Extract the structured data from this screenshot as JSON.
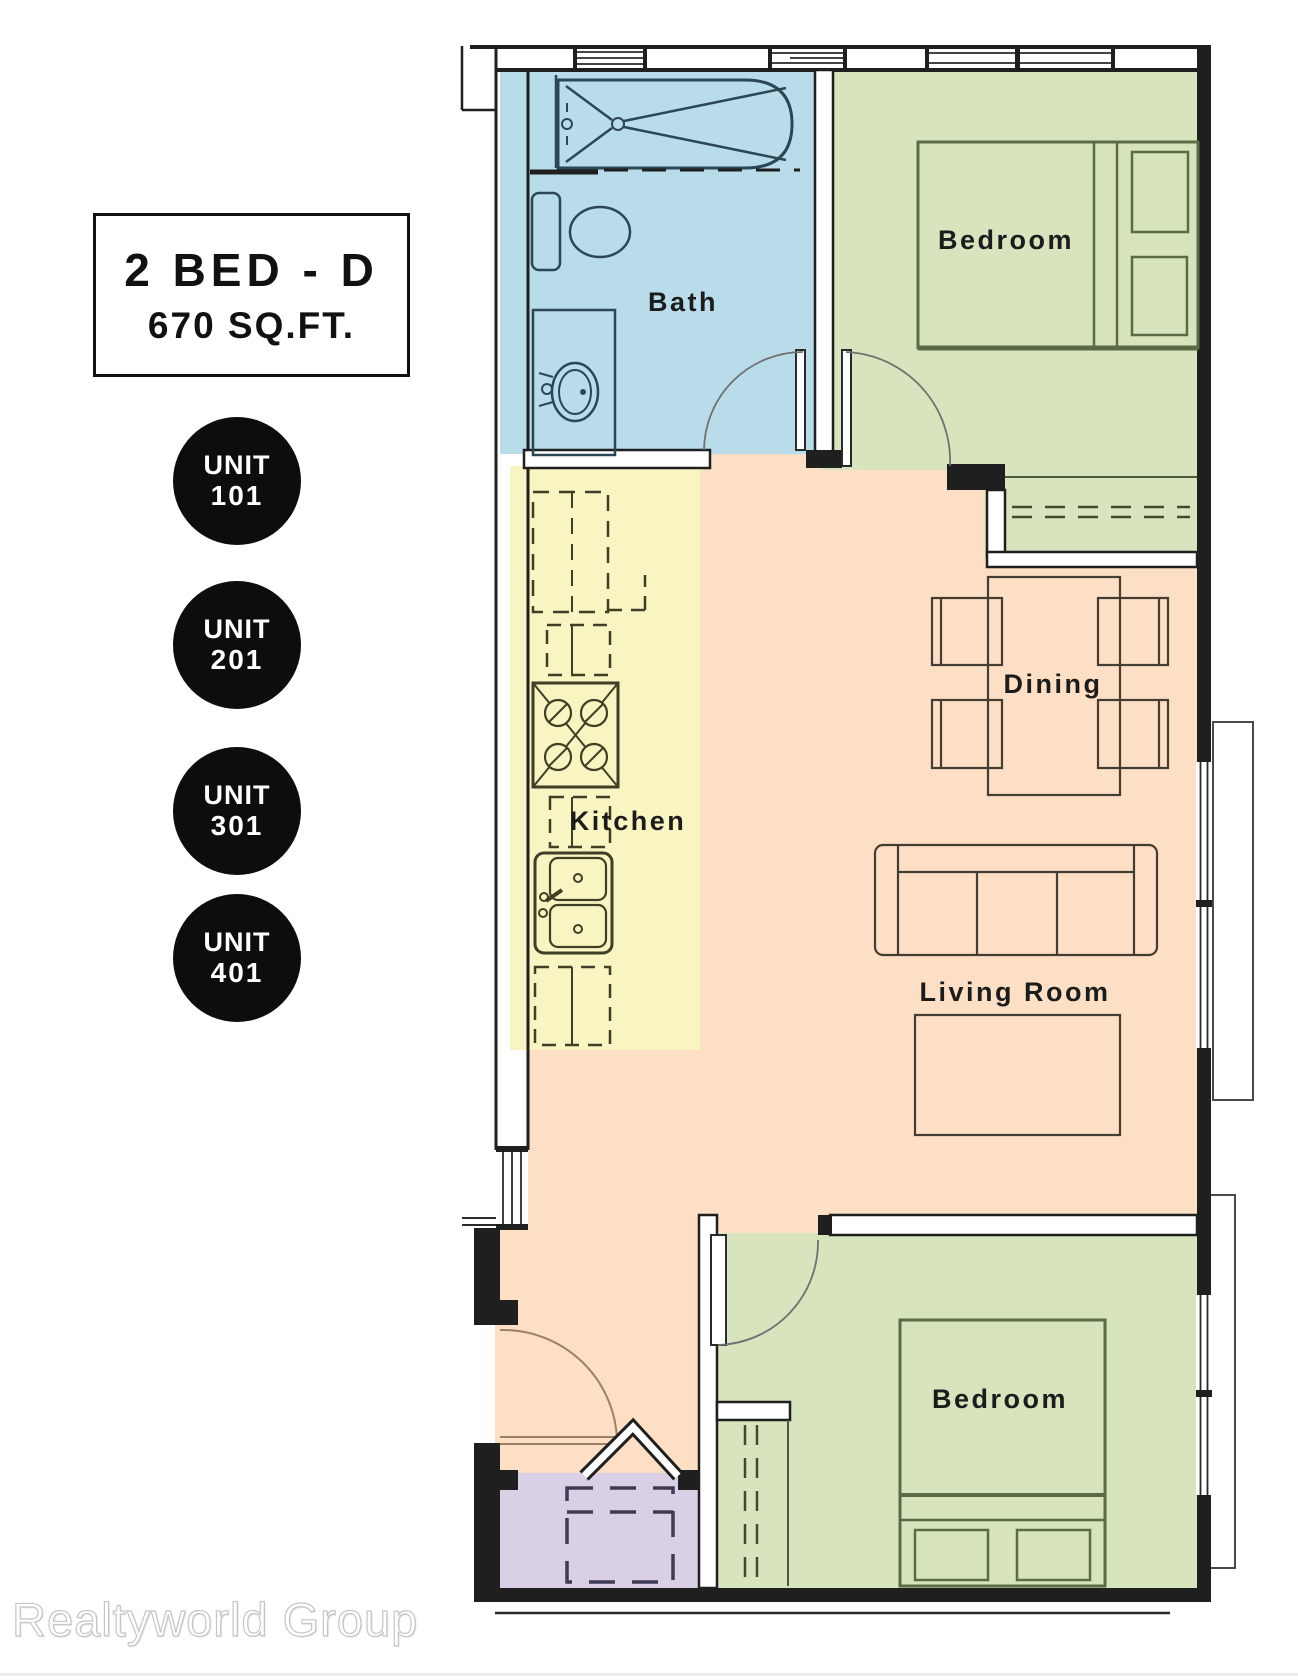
{
  "title": {
    "line1": "2 BED - D",
    "line2": "670 SQ.FT."
  },
  "units": [
    {
      "line1": "UNIT",
      "line2": "101"
    },
    {
      "line1": "UNIT",
      "line2": "201"
    },
    {
      "line1": "UNIT",
      "line2": "301"
    },
    {
      "line1": "UNIT",
      "line2": "401"
    }
  ],
  "rooms": {
    "bath": {
      "label": "Bath"
    },
    "bedroom1": {
      "label": "Bedroom"
    },
    "kitchen": {
      "label": "Kitchen"
    },
    "dining": {
      "label": "Dining"
    },
    "living": {
      "label": "Living Room"
    },
    "bedroom2": {
      "label": "Bedroom"
    }
  },
  "colors": {
    "bath": "#b9dceb",
    "bedroom": "#d7e4bd",
    "kitchen": "#f9f5c3",
    "living_dining": "#fcdfc4",
    "entry": "#d9d0e6",
    "wall": "#1f1f1f",
    "unit_badge": "#0d0d0d",
    "label_text": "#1c1c1c"
  },
  "watermark": "Realtyworld Group"
}
